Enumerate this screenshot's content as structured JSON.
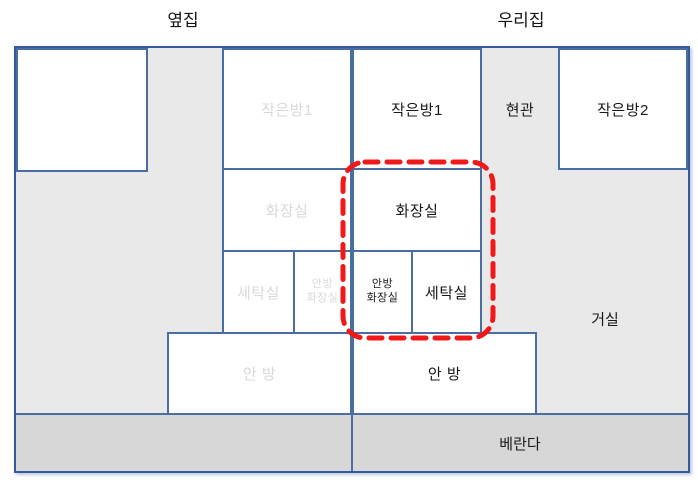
{
  "titles": {
    "left_house": "옆집",
    "right_house": "우리집"
  },
  "left_apartment": {
    "label_style": "faded",
    "rooms": {
      "small_room_1": "작은방1",
      "bathroom": "화장실",
      "laundry_room": "세탁실",
      "master_bathroom_line1": "안방",
      "master_bathroom_line2": "화장실",
      "master_room": "안 방"
    }
  },
  "right_apartment": {
    "label_style": "black",
    "rooms": {
      "small_room_1": "작은방1",
      "entrance": "현관",
      "small_room_2": "작은방2",
      "bathroom": "화장실",
      "master_bathroom_line1": "안방",
      "master_bathroom_line2": "화장실",
      "laundry_room": "세탁실",
      "master_room": "안 방",
      "living_room": "거실",
      "veranda": "베란다"
    }
  },
  "highlight": {
    "shape": "dashed-rounded-rectangle",
    "color": "#f01818",
    "encloses": [
      "화장실",
      "안방 화장실",
      "세탁실"
    ]
  },
  "colors": {
    "wall_line": "#4a6da2",
    "outer_border": "#35599e",
    "apartment_floor": "#e9e9e9",
    "veranda_floor": "#d7d7d7",
    "faded_label": "#d9d9d9",
    "label": "#1a1a1a"
  }
}
